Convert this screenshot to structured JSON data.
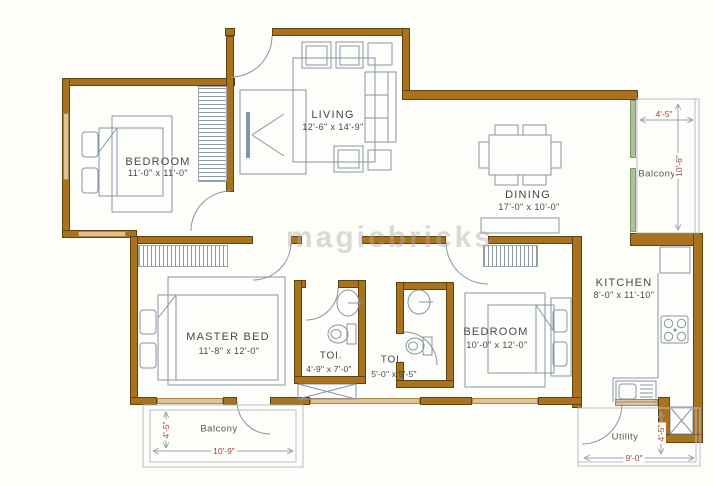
{
  "watermark": "magicbricks",
  "rooms": {
    "bedroom1": {
      "name": "BEDROOM",
      "dims": "11'-0\" x 11'-0\""
    },
    "living": {
      "name": "LIVING",
      "dims": "12'-6\" x 14'-9\""
    },
    "dining": {
      "name": "DINING",
      "dims": "17'-0\" x 10'-0\""
    },
    "kitchen": {
      "name": "KITCHEN",
      "dims": "8'-0\" x 11'-10\""
    },
    "master": {
      "name": "MASTER BED",
      "dims": "11'-8\" x 12'-0\""
    },
    "bedroom2": {
      "name": "BEDROOM",
      "dims": "10'-0\" x 12'-0\""
    },
    "toilet1": {
      "name": "TOI.",
      "dims": "4'-9\" x 7'-0\""
    },
    "toilet2": {
      "name": "TOI.",
      "dims": "5'-0\" x 5'-5\""
    },
    "balcony_right": {
      "name": "Balcony",
      "width_dim": "4'-5\"",
      "height_dim": "10'-6\""
    },
    "balcony_bottom": {
      "name": "Balcony",
      "width_dim": "10'-9\"",
      "height_dim": "4'-5\""
    },
    "utility": {
      "name": "Utility",
      "width_dim": "9'-0\"",
      "height_dim": "4'-5\""
    }
  },
  "colors": {
    "wall": "#a8721e",
    "wallBorder": "#5f430f",
    "window": "#dfc392",
    "glass": "#aec29a",
    "line": "#8695a5",
    "dimText": "#9c4545",
    "labelText": "#45484c",
    "paper": "#fdfdfa",
    "watermark": "rgba(178,174,166,0.45)"
  }
}
